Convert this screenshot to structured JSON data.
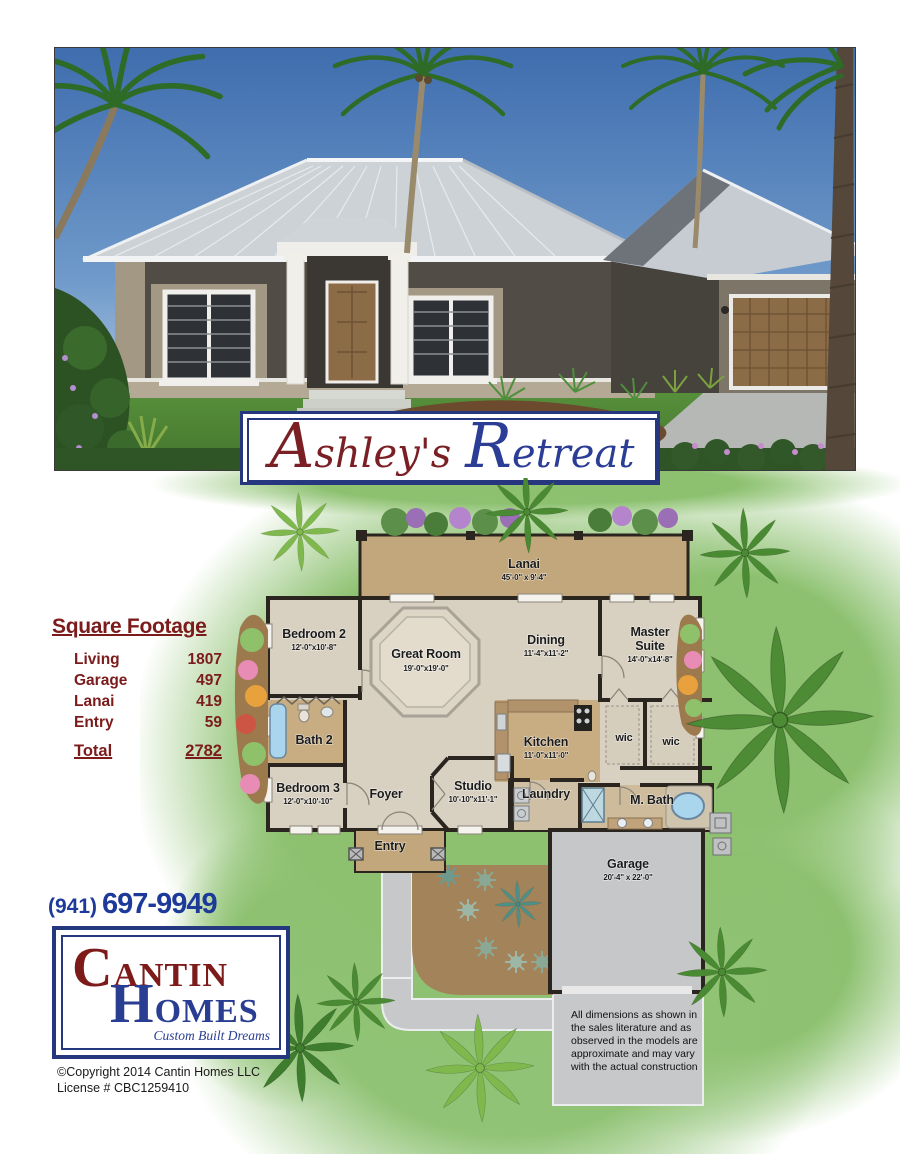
{
  "banner": {
    "word1": "Ashley's",
    "word2": "Retreat"
  },
  "sqft": {
    "title": "Square Footage",
    "rows": [
      {
        "label": "Living",
        "value": "1807"
      },
      {
        "label": "Garage",
        "value": "497"
      },
      {
        "label": "Lanai",
        "value": "419"
      },
      {
        "label": "Entry",
        "value": "59"
      }
    ],
    "total": {
      "label": "Total",
      "value": "2782"
    }
  },
  "phone": {
    "area": "(941)",
    "number": "697-9949"
  },
  "logo": {
    "line1": "CANTIN",
    "line2": "HOMES",
    "tagline": "Custom Built Dreams"
  },
  "footer": {
    "copyright": "©Copyright 2014 Cantin Homes LLC",
    "license": "License # CBC1259410"
  },
  "disclaimer": {
    "text": "All dimensions as shown in the sales literature and as observed in the models are approximate and may vary with the actual construction"
  },
  "plan": {
    "lanai": {
      "name": "Lanai",
      "dims": "45'-0\" x 9'-4\""
    },
    "bedroom2": {
      "name": "Bedroom 2",
      "dims": "12'-0\"x10'-8\""
    },
    "great_room": {
      "name": "Great Room",
      "dims": "19'-0\"x19'-0\""
    },
    "dining": {
      "name": "Dining",
      "dims": "11'-4\"x11'-2\""
    },
    "master": {
      "line1": "Master",
      "line2": "Suite",
      "dims": "14'-0\"x14'-8\""
    },
    "bath2": {
      "name": "Bath 2"
    },
    "kitchen": {
      "name": "Kitchen",
      "dims": "11'-0\"x11'-0\""
    },
    "wic1": {
      "name": "wic"
    },
    "wic2": {
      "name": "wic"
    },
    "bedroom3": {
      "name": "Bedroom 3",
      "dims": "12'-0\"x10'-10\""
    },
    "foyer": {
      "name": "Foyer"
    },
    "studio": {
      "name": "Studio",
      "dims": "10'-10\"x11'-1\""
    },
    "laundry": {
      "name": "Laundry"
    },
    "mbath": {
      "name": "M. Bath"
    },
    "entry": {
      "name": "Entry"
    },
    "garage": {
      "name": "Garage",
      "dims": "20'-4\" x 22'-0\""
    }
  },
  "colors": {
    "maroon": "#7c1b1b",
    "navy": "#24377f",
    "lawn_green": "#8dc170",
    "lanai_tan": "#c2a77c",
    "wall_dark": "#2b2520",
    "driveway_gray": "#c6c8ca"
  }
}
